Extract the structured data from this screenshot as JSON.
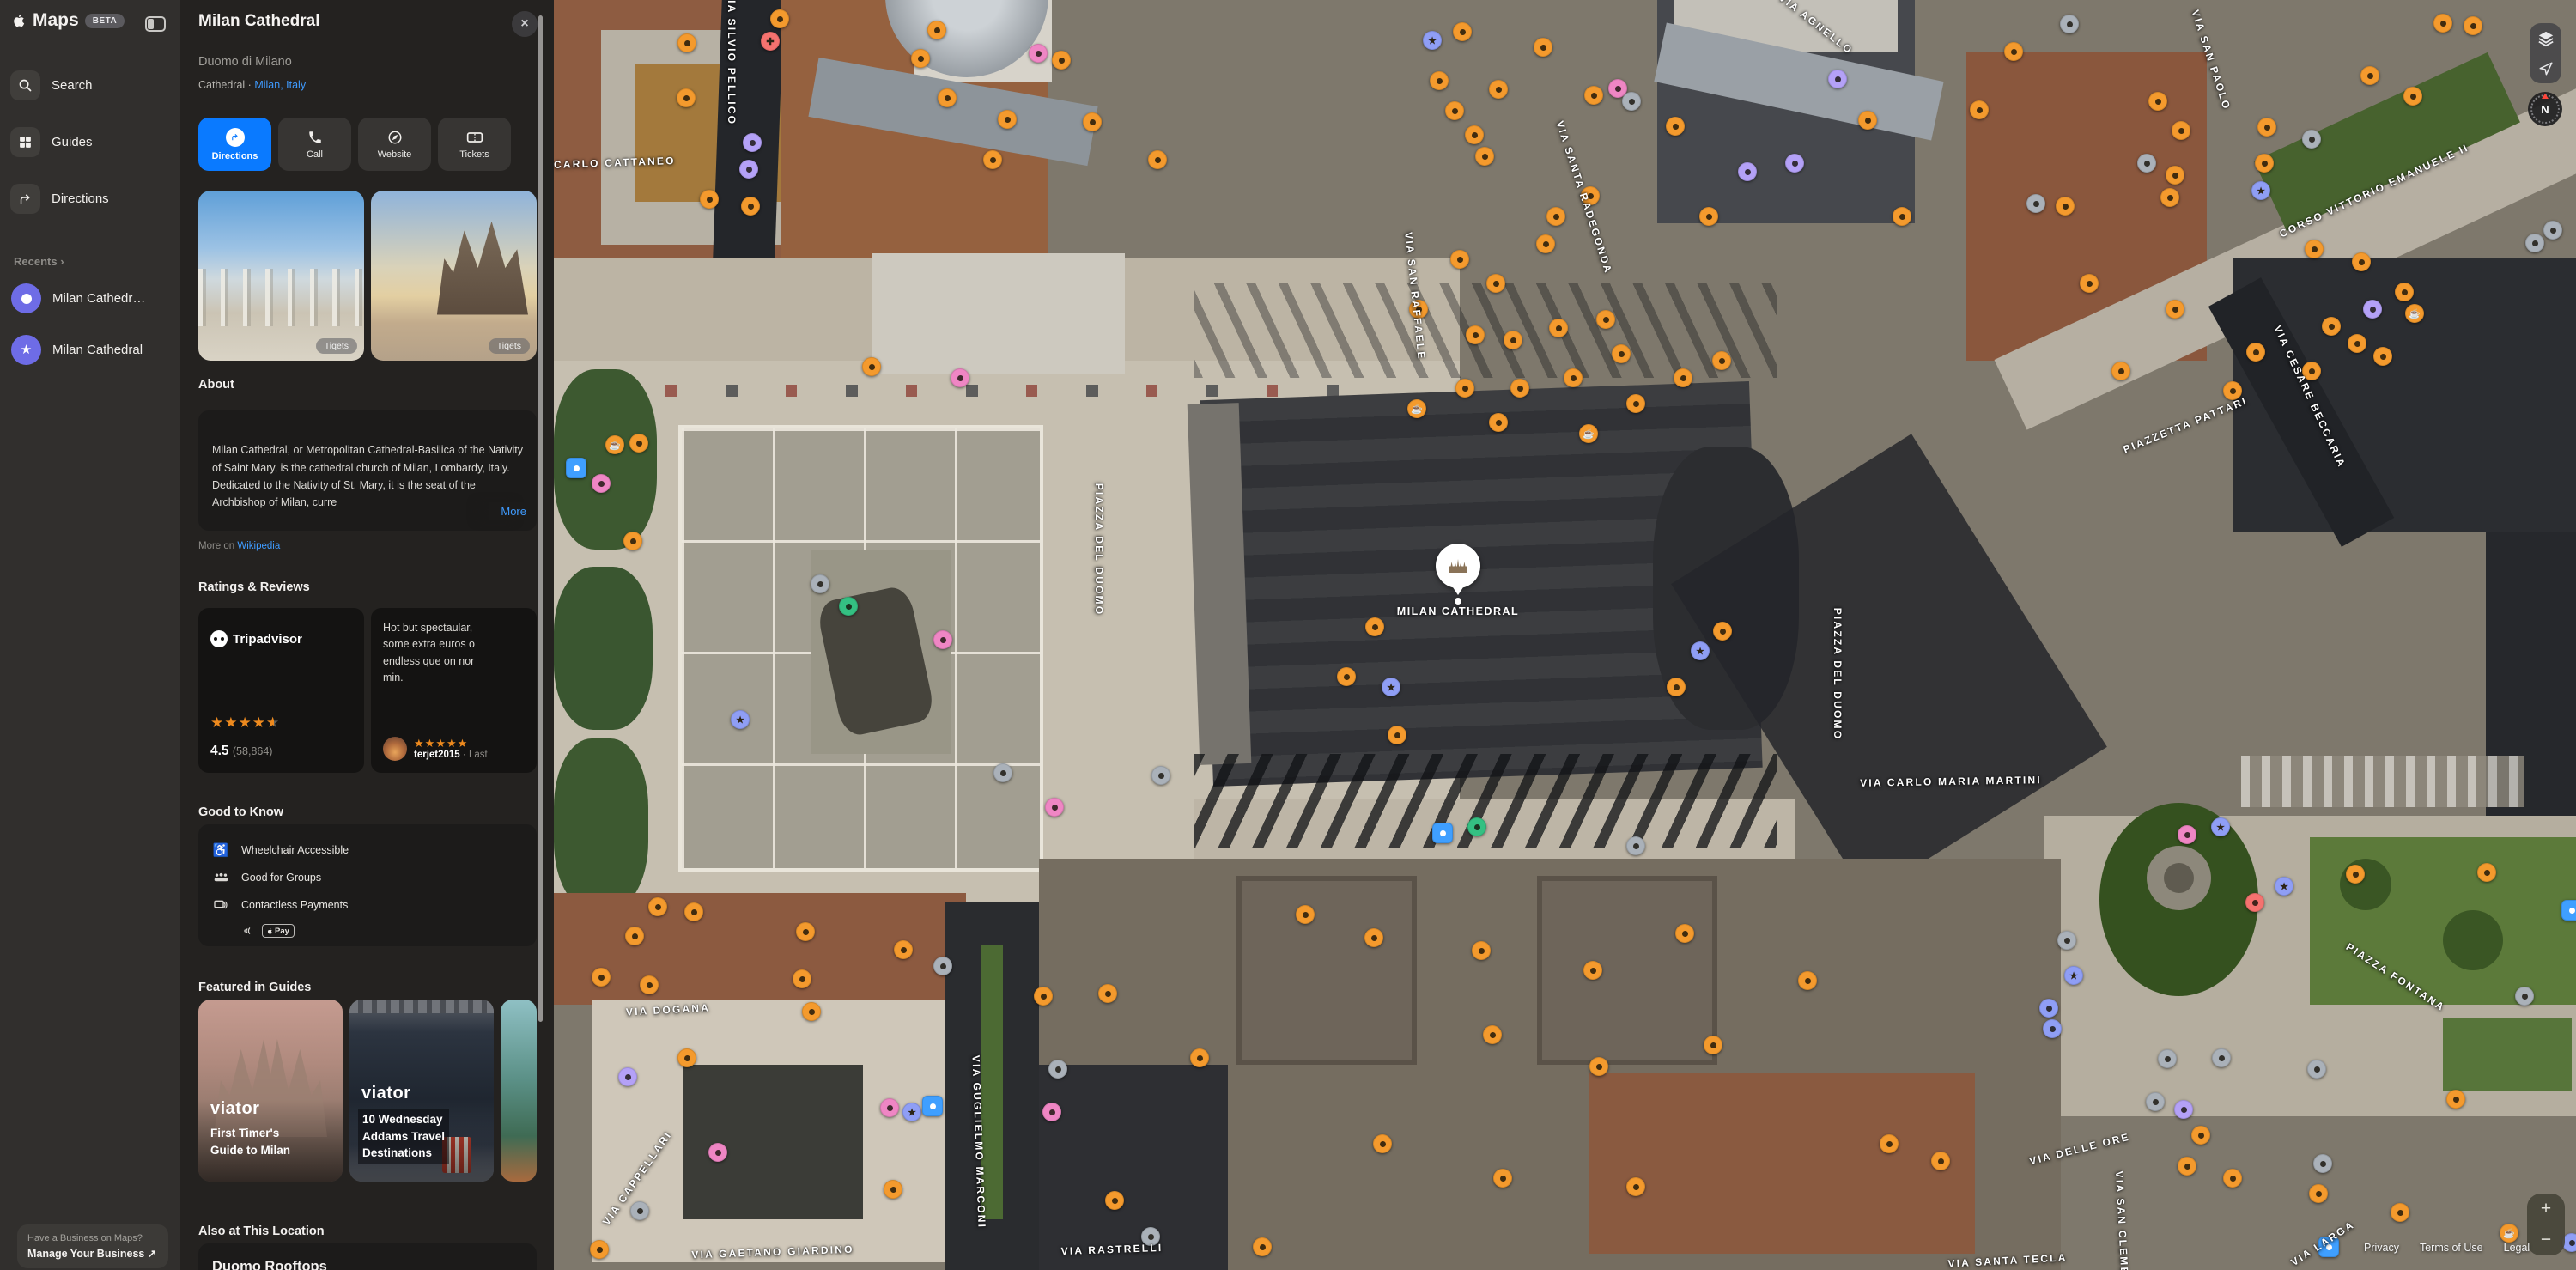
{
  "app": {
    "name": "Maps",
    "beta": "BETA"
  },
  "sidebar": {
    "nav": [
      {
        "label": "Search"
      },
      {
        "label": "Guides"
      },
      {
        "label": "Directions"
      }
    ],
    "recents_label": "Recents",
    "recents_chevron": "›",
    "recents": [
      {
        "label": "Milan Cathedr…"
      },
      {
        "label": "Milan Cathedral"
      }
    ],
    "business": {
      "line1": "Have a Business on Maps?",
      "line2": "Manage Your Business ↗"
    }
  },
  "place": {
    "title": "Milan Cathedral",
    "subtitle": "Duomo di Milano",
    "category": "Cathedral ·",
    "location_link": "Milan, Italy",
    "close": "×",
    "actions": [
      {
        "label": "Directions"
      },
      {
        "label": "Call"
      },
      {
        "label": "Website"
      },
      {
        "label": "Tickets"
      }
    ],
    "photo_credit": "Tiqets",
    "about": {
      "heading": "About",
      "text": "Milan Cathedral, or Metropolitan Cathedral-Basilica of the Nativity of Saint Mary, is the cathedral church of Milan, Lombardy, Italy. Dedicated to the Nativity of St. Mary, it is the seat of the Archbishop of Milan, curre",
      "more": "More",
      "source_prefix": "More on",
      "source_link": "Wikipedia"
    },
    "reviews": {
      "heading": "Ratings & Reviews",
      "provider": "Tripadvisor",
      "rating": "4.5",
      "count": "(58,864)",
      "review_text": "Hot but spectaular,\nsome extra euros o\nendless que on nor\nmin.",
      "review_user": "terjet2015",
      "review_meta": "· Last"
    },
    "good_to_know": {
      "heading": "Good to Know",
      "items": [
        "Wheelchair Accessible",
        "Good for Groups",
        "Contactless Payments"
      ],
      "pay_badge": "Pay"
    },
    "guides": {
      "heading": "Featured in Guides",
      "cards": [
        {
          "brand": "viator",
          "title": "First Timer's\nGuide to Milan"
        },
        {
          "brand": "viator",
          "title": "10 Wednesday\nAddams Travel\nDestinations"
        }
      ]
    },
    "also": {
      "heading": "Also at This Location",
      "item": "Duomo Rooftops"
    }
  },
  "map": {
    "place_label": "MILAN CATHEDRAL",
    "compass": "N",
    "zoom_in": "+",
    "zoom_out": "−",
    "legal": [
      "Privacy",
      "Terms of Use",
      "Legal"
    ],
    "labels": [
      [
        "VIA CARLO CATTANEO",
        700,
        190,
        -2
      ],
      [
        "VIA SILVIO PELLICO",
        852,
        68,
        90
      ],
      [
        "VIA SAN RAFFAELE",
        1648,
        345,
        84
      ],
      [
        "VIA SANTA RADEGONDA",
        1845,
        230,
        72
      ],
      [
        "VIA AGNELLO",
        2115,
        28,
        38
      ],
      [
        "VIA SAN PAOLO",
        2575,
        70,
        72
      ],
      [
        "CORSO VITTORIO EMANUELE II",
        2765,
        222,
        -25
      ],
      [
        "PIAZZETTA PATTARI",
        2545,
        495,
        -22
      ],
      [
        "VIA CESARE BECCARIA",
        2690,
        462,
        65
      ],
      [
        "PIAZZA DEL DUOMO",
        1280,
        640,
        90
      ],
      [
        "PIAZZA DEL DUOMO",
        2140,
        785,
        90
      ],
      [
        "VIA CARLO MARIA MARTINI",
        2272,
        910,
        -1
      ],
      [
        "VIA DOGANA",
        778,
        1176,
        -3
      ],
      [
        "VIA CAPPELLARI",
        742,
        1372,
        -55
      ],
      [
        "VIA GUGLIELMO MARCONI",
        1140,
        1330,
        88
      ],
      [
        "VIA GAETANO GIARDINO",
        900,
        1458,
        -2
      ],
      [
        "VIA RASTRELLI",
        1295,
        1455,
        -2
      ],
      [
        "PIAZZA FONTANA",
        2790,
        1138,
        33
      ],
      [
        "VIA DELLE ORE",
        2422,
        1338,
        -14
      ],
      [
        "VIA SAN CLEMENTE",
        2472,
        1440,
        87
      ],
      [
        "VIA LARGA",
        2705,
        1448,
        -33
      ],
      [
        "VIA SANTA TECLA",
        2338,
        1468,
        -3
      ]
    ],
    "markers": [
      [
        800,
        50,
        "o"
      ],
      [
        799,
        114,
        "o"
      ],
      [
        908,
        22,
        "o"
      ],
      [
        897,
        48,
        "r",
        "x"
      ],
      [
        876,
        166,
        "p"
      ],
      [
        872,
        197,
        "p"
      ],
      [
        826,
        232,
        "o"
      ],
      [
        874,
        240,
        "o"
      ],
      [
        1072,
        68,
        "o"
      ],
      [
        1091,
        35,
        "o"
      ],
      [
        1103,
        114,
        "o"
      ],
      [
        1173,
        139,
        "o"
      ],
      [
        1156,
        186,
        "o"
      ],
      [
        1209,
        62,
        "k"
      ],
      [
        1236,
        70,
        "o"
      ],
      [
        1272,
        142,
        "o"
      ],
      [
        1348,
        186,
        "o"
      ],
      [
        716,
        518,
        "o",
        "c"
      ],
      [
        744,
        516,
        "o"
      ],
      [
        737,
        630,
        "o"
      ],
      [
        1015,
        427,
        "o"
      ],
      [
        1118,
        440,
        "k"
      ],
      [
        955,
        680,
        "g"
      ],
      [
        988,
        706,
        "G"
      ],
      [
        1098,
        745,
        "k"
      ],
      [
        862,
        838,
        "b",
        "s"
      ],
      [
        1168,
        900,
        "g"
      ],
      [
        1228,
        940,
        "k"
      ],
      [
        671,
        545,
        "B"
      ],
      [
        700,
        563,
        "k"
      ],
      [
        1352,
        903,
        "g"
      ],
      [
        1568,
        788,
        "o"
      ],
      [
        1601,
        730,
        "o"
      ],
      [
        1620,
        800,
        "b",
        "s"
      ],
      [
        1627,
        856,
        "o"
      ],
      [
        1980,
        758,
        "b",
        "s"
      ],
      [
        2006,
        735,
        "o"
      ],
      [
        1952,
        800,
        "o"
      ],
      [
        1720,
        963,
        "G"
      ],
      [
        1680,
        970,
        "B"
      ],
      [
        1905,
        985,
        "g"
      ],
      [
        1668,
        47,
        "b",
        "s"
      ],
      [
        1703,
        37,
        "o"
      ],
      [
        1745,
        104,
        "o"
      ],
      [
        1797,
        55,
        "o"
      ],
      [
        1676,
        94,
        "o"
      ],
      [
        1694,
        129,
        "o"
      ],
      [
        1717,
        157,
        "o"
      ],
      [
        1729,
        182,
        "o"
      ],
      [
        1856,
        111,
        "o"
      ],
      [
        1884,
        103,
        "k"
      ],
      [
        1900,
        118,
        "g"
      ],
      [
        1951,
        147,
        "o"
      ],
      [
        1852,
        228,
        "o"
      ],
      [
        1812,
        252,
        "o"
      ],
      [
        1800,
        284,
        "o"
      ],
      [
        1742,
        330,
        "o"
      ],
      [
        1700,
        302,
        "o"
      ],
      [
        1652,
        360,
        "o"
      ],
      [
        1718,
        390,
        "o"
      ],
      [
        1762,
        396,
        "o"
      ],
      [
        1815,
        382,
        "o"
      ],
      [
        1870,
        372,
        "o"
      ],
      [
        1888,
        412,
        "o"
      ],
      [
        1832,
        440,
        "o"
      ],
      [
        1770,
        452,
        "o"
      ],
      [
        1706,
        452,
        "o"
      ],
      [
        1650,
        476,
        "o",
        "c"
      ],
      [
        1745,
        492,
        "o"
      ],
      [
        1850,
        505,
        "o",
        "c"
      ],
      [
        1905,
        470,
        "o"
      ],
      [
        1960,
        440,
        "o"
      ],
      [
        2005,
        420,
        "o"
      ],
      [
        1990,
        252,
        "o"
      ],
      [
        2035,
        200,
        "p"
      ],
      [
        2090,
        190,
        "p"
      ],
      [
        2140,
        92,
        "p"
      ],
      [
        2175,
        140,
        "o"
      ],
      [
        2215,
        252,
        "o"
      ],
      [
        2305,
        128,
        "o"
      ],
      [
        2345,
        60,
        "o"
      ],
      [
        2410,
        28,
        "g"
      ],
      [
        2513,
        118,
        "o"
      ],
      [
        2540,
        152,
        "o"
      ],
      [
        2533,
        204,
        "o"
      ],
      [
        2527,
        230,
        "o"
      ],
      [
        2500,
        190,
        "g"
      ],
      [
        2371,
        237,
        "g"
      ],
      [
        2405,
        240,
        "o"
      ],
      [
        2433,
        330,
        "o"
      ],
      [
        2640,
        148,
        "o"
      ],
      [
        2637,
        190,
        "o"
      ],
      [
        2633,
        222,
        "b",
        "s"
      ],
      [
        2692,
        162,
        "g"
      ],
      [
        2845,
        27,
        "o"
      ],
      [
        2880,
        30,
        "o"
      ],
      [
        2760,
        88,
        "o"
      ],
      [
        2810,
        112,
        "o"
      ],
      [
        2695,
        290,
        "o"
      ],
      [
        2750,
        305,
        "o"
      ],
      [
        2800,
        340,
        "o"
      ],
      [
        2763,
        360,
        "p"
      ],
      [
        2812,
        365,
        "o",
        "c"
      ],
      [
        2745,
        400,
        "o"
      ],
      [
        2775,
        415,
        "o"
      ],
      [
        2715,
        380,
        "o"
      ],
      [
        2692,
        432,
        "o"
      ],
      [
        2627,
        410,
        "o"
      ],
      [
        2533,
        360,
        "o"
      ],
      [
        2470,
        432,
        "o"
      ],
      [
        2600,
        455,
        "o"
      ],
      [
        2952,
        283,
        "g"
      ],
      [
        2973,
        268,
        "g"
      ],
      [
        2547,
        972,
        "k"
      ],
      [
        2586,
        963,
        "b",
        "s"
      ],
      [
        2660,
        1032,
        "b",
        "s"
      ],
      [
        2626,
        1051,
        "r"
      ],
      [
        2743,
        1018,
        "o"
      ],
      [
        2415,
        1136,
        "b",
        "s"
      ],
      [
        2386,
        1174,
        "b"
      ],
      [
        2390,
        1198,
        "b"
      ],
      [
        2407,
        1095,
        "g"
      ],
      [
        2896,
        1016,
        "o"
      ],
      [
        2940,
        1160,
        "g"
      ],
      [
        2995,
        1060,
        "B"
      ],
      [
        2524,
        1233,
        "g"
      ],
      [
        2587,
        1232,
        "g"
      ],
      [
        2698,
        1245,
        "g"
      ],
      [
        2510,
        1283,
        "g"
      ],
      [
        2543,
        1292,
        "p"
      ],
      [
        2563,
        1322,
        "o"
      ],
      [
        2547,
        1358,
        "o"
      ],
      [
        2600,
        1372,
        "o"
      ],
      [
        2700,
        1390,
        "o"
      ],
      [
        2795,
        1412,
        "o"
      ],
      [
        2705,
        1355,
        "g"
      ],
      [
        2860,
        1280,
        "o"
      ],
      [
        2922,
        1436,
        "o",
        "c"
      ],
      [
        2995,
        1447,
        "b"
      ],
      [
        766,
        1056,
        "o"
      ],
      [
        808,
        1062,
        "o"
      ],
      [
        739,
        1090,
        "o"
      ],
      [
        700,
        1138,
        "o"
      ],
      [
        756,
        1147,
        "o"
      ],
      [
        938,
        1085,
        "o"
      ],
      [
        934,
        1140,
        "o"
      ],
      [
        945,
        1178,
        "o"
      ],
      [
        1052,
        1106,
        "o"
      ],
      [
        1098,
        1125,
        "g"
      ],
      [
        731,
        1254,
        "p"
      ],
      [
        800,
        1232,
        "o"
      ],
      [
        836,
        1342,
        "k"
      ],
      [
        1036,
        1290,
        "k"
      ],
      [
        1062,
        1295,
        "b",
        "s"
      ],
      [
        1086,
        1288,
        "B"
      ],
      [
        1040,
        1385,
        "o"
      ],
      [
        745,
        1410,
        "g"
      ],
      [
        698,
        1455,
        "o"
      ],
      [
        1225,
        1295,
        "k"
      ],
      [
        1215,
        1160,
        "o"
      ],
      [
        1290,
        1157,
        "o"
      ],
      [
        1232,
        1245,
        "g"
      ],
      [
        1397,
        1232,
        "o"
      ],
      [
        1520,
        1065,
        "o"
      ],
      [
        1600,
        1092,
        "o"
      ],
      [
        1725,
        1107,
        "o"
      ],
      [
        1855,
        1130,
        "o"
      ],
      [
        1962,
        1087,
        "o"
      ],
      [
        2105,
        1142,
        "o"
      ],
      [
        1738,
        1205,
        "o"
      ],
      [
        1862,
        1242,
        "o"
      ],
      [
        1995,
        1217,
        "o"
      ],
      [
        1610,
        1332,
        "o"
      ],
      [
        1750,
        1372,
        "o"
      ],
      [
        1905,
        1382,
        "o"
      ],
      [
        1298,
        1398,
        "o"
      ],
      [
        1340,
        1440,
        "g"
      ],
      [
        1470,
        1452,
        "o"
      ],
      [
        2200,
        1332,
        "o"
      ],
      [
        2260,
        1352,
        "o"
      ],
      [
        2712,
        1452,
        "B"
      ]
    ]
  },
  "colors": {
    "accent": "#0a7aff",
    "link": "#3f9bff",
    "star": "#ee8a1e",
    "marker_orange": "#f49a2d",
    "marker_purple": "#b4a1f7",
    "marker_blue": "#8f9ef5",
    "marker_gray": "#aab1b9",
    "marker_pink": "#ef86c4",
    "marker_red": "#f5726f",
    "marker_bright_blue": "#3f9fff",
    "marker_green": "#34c082"
  }
}
